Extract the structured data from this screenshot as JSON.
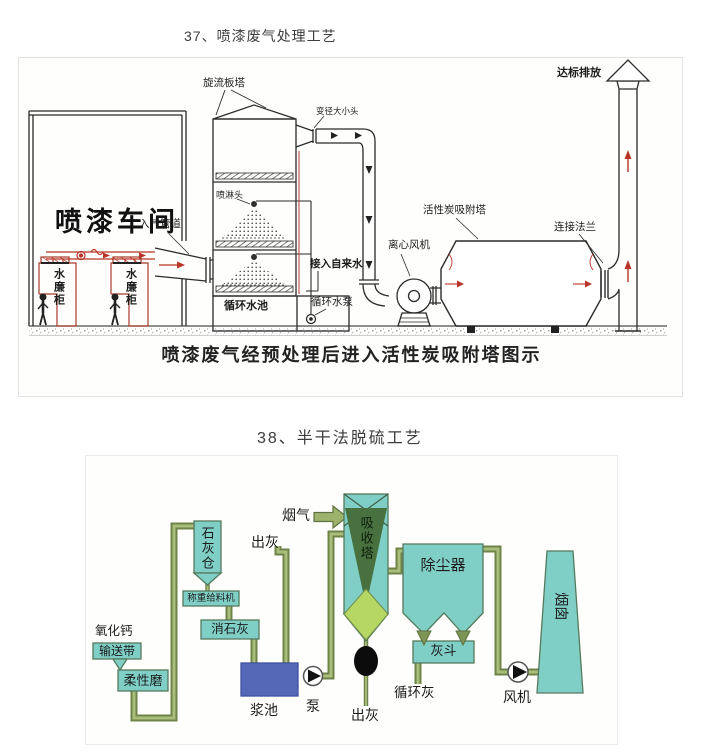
{
  "section1": {
    "title": "37、喷漆废气处理工艺",
    "caption": "喷漆废气经预处理后进入活性炭吸附塔图示",
    "labels": {
      "spray_tower": "旋流板塔",
      "reducer": "变径大小头",
      "discharge": "达标排放",
      "workshop": "喷漆车间",
      "inlet_pipe": "入气管道",
      "spray_head": "喷淋头",
      "tap_water": "接入自来水",
      "fan": "离心风机",
      "carbon_tower": "活性炭吸附塔",
      "flange": "连接法兰",
      "pool": "循环水池",
      "water_pump": "循环水泵",
      "curtain_cabinet": "水廉柜"
    },
    "colors": {
      "line": "#2b2b2b",
      "red_accent": "#b73527"
    }
  },
  "section2": {
    "title": "38、半干法脱硫工艺",
    "labels": {
      "flue_gas": "烟气",
      "ash_out_top": "出灰",
      "lime_silo": "石灰仓",
      "weighing_feeder": "称重给料机",
      "slaked_lime": "消石灰",
      "calcium_oxide": "氧化钙",
      "conveyor": "输送带",
      "flexible_mill": "柔性磨",
      "slurry_pool": "浆池",
      "pump": "泵",
      "ash_out_bottom": "出灰",
      "absorber": "吸收塔",
      "dust_collector": "除尘器",
      "ash_hopper": "灰斗",
      "circulating_ash": "循环灰",
      "fan": "风机",
      "chimney": "烟囱"
    },
    "colors": {
      "teal": "#7fcfc6",
      "pipe_dark": "#6e8348",
      "pipe_light": "#abbe7b",
      "pool_blue": "#5568b8",
      "tower_dark_green": "#48713f",
      "tower_light_green": "#b7d765"
    }
  }
}
